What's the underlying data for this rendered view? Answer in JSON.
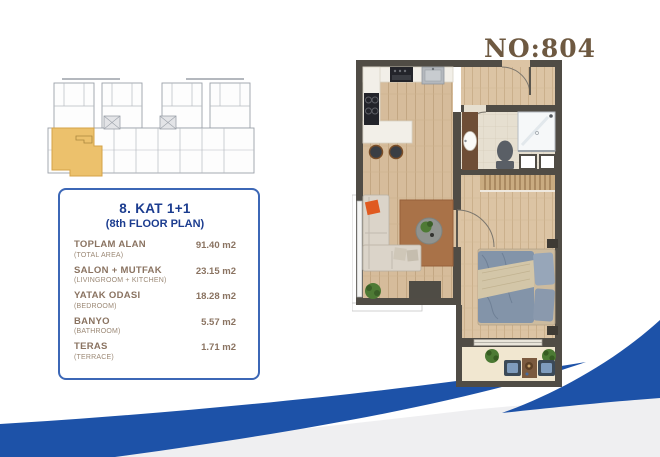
{
  "header": {
    "unit_number": "NO:804"
  },
  "info_card": {
    "title": "8. KAT 1+1",
    "subtitle": "(8th FLOOR PLAN)",
    "rows": [
      {
        "label": "TOPLAM ALAN",
        "sublabel": "(TOTAL AREA)",
        "value": "91.40 m2"
      },
      {
        "label": "SALON + MUTFAK",
        "sublabel": "(LIVINGROOM + KITCHEN)",
        "value": "23.15 m2"
      },
      {
        "label": "YATAK ODASI",
        "sublabel": "(BEDROOM)",
        "value": "18.28 m2"
      },
      {
        "label": "BANYO",
        "sublabel": "(BATHROOM)",
        "value": "5.57 m2"
      },
      {
        "label": "TERAS",
        "sublabel": "(TERRACE)",
        "value": "1.71 m2"
      }
    ]
  },
  "colors": {
    "accent_blue": "#1d52a8",
    "wave_gray": "#efeff1",
    "card_border_blue": "#3c67b6",
    "card_title_blue": "#1b3c8f",
    "card_text_brown": "#8a7361",
    "unit_number_brown": "#6e5941",
    "highlight_amber": "#ecc16c",
    "plan_wall": "#504c45",
    "plan_wood": "#d6bc9b",
    "plan_tile": "#e6dfd0"
  }
}
